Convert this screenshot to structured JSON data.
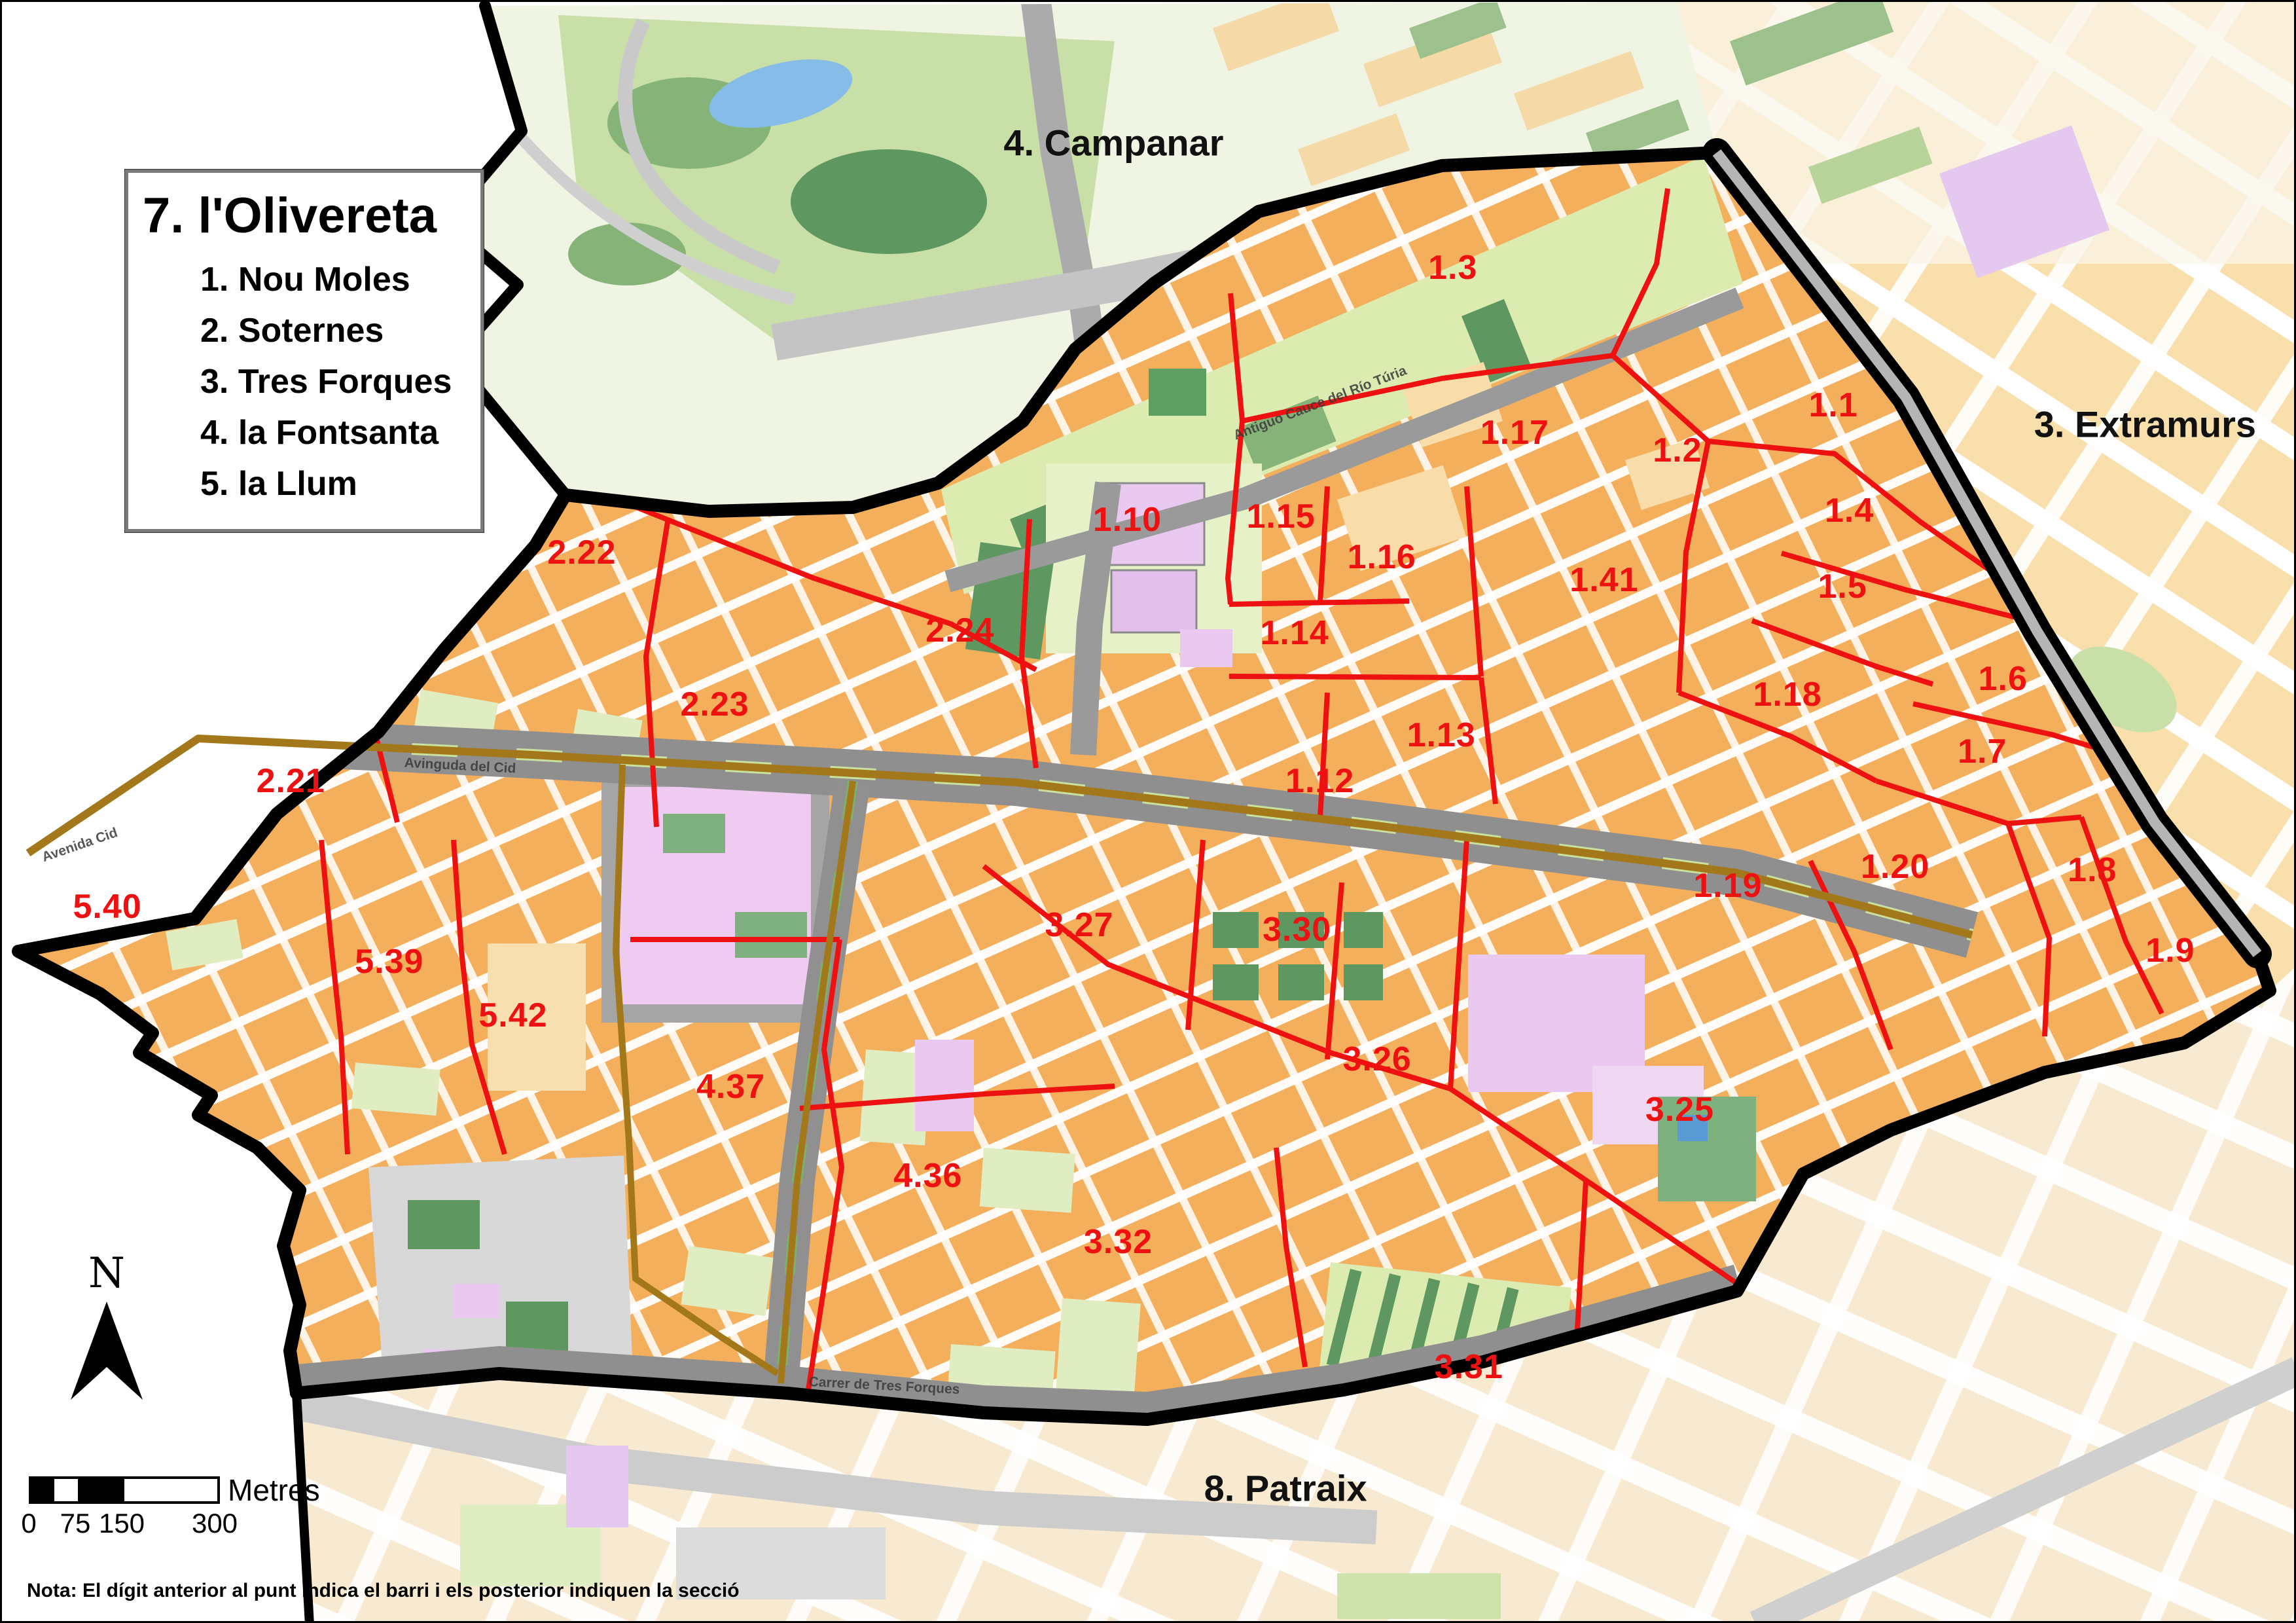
{
  "map": {
    "title_box": {
      "title": "7. l'Olivereta",
      "items": [
        "1. Nou Moles",
        "2. Soternes",
        "3. Tres Forques",
        "4. la Fontsanta",
        "5. la Llum"
      ]
    },
    "neighbor_districts": [
      {
        "name": "4. Campanar",
        "x_pct": 48.5,
        "y_pct": 8.7
      },
      {
        "name": "3. Extramurs",
        "x_pct": 93.5,
        "y_pct": 26.1
      },
      {
        "name": "8. Patraix",
        "x_pct": 56.0,
        "y_pct": 91.8
      }
    ],
    "sections": [
      {
        "label": "1.3",
        "x_pct": 63.3,
        "y_pct": 16.4
      },
      {
        "label": "1.1",
        "x_pct": 79.9,
        "y_pct": 24.9
      },
      {
        "label": "1.17",
        "x_pct": 66.0,
        "y_pct": 26.6
      },
      {
        "label": "1.2",
        "x_pct": 73.1,
        "y_pct": 27.7
      },
      {
        "label": "1.4",
        "x_pct": 80.6,
        "y_pct": 31.4
      },
      {
        "label": "1.15",
        "x_pct": 55.8,
        "y_pct": 31.8
      },
      {
        "label": "1.10",
        "x_pct": 49.1,
        "y_pct": 32.0
      },
      {
        "label": "2.22",
        "x_pct": 25.3,
        "y_pct": 34.0
      },
      {
        "label": "1.16",
        "x_pct": 60.2,
        "y_pct": 34.3
      },
      {
        "label": "1.41",
        "x_pct": 69.9,
        "y_pct": 35.7
      },
      {
        "label": "1.5",
        "x_pct": 80.3,
        "y_pct": 36.1
      },
      {
        "label": "2.24",
        "x_pct": 41.8,
        "y_pct": 38.8
      },
      {
        "label": "1.14",
        "x_pct": 56.4,
        "y_pct": 39.0
      },
      {
        "label": "1.6",
        "x_pct": 87.3,
        "y_pct": 41.8
      },
      {
        "label": "1.18",
        "x_pct": 77.9,
        "y_pct": 42.8
      },
      {
        "label": "2.23",
        "x_pct": 31.1,
        "y_pct": 43.4
      },
      {
        "label": "1.13",
        "x_pct": 62.8,
        "y_pct": 45.3
      },
      {
        "label": "1.7",
        "x_pct": 86.4,
        "y_pct": 46.3
      },
      {
        "label": "1.12",
        "x_pct": 57.5,
        "y_pct": 48.1
      },
      {
        "label": "2.21",
        "x_pct": 12.6,
        "y_pct": 48.1
      },
      {
        "label": "1.20",
        "x_pct": 82.6,
        "y_pct": 53.4
      },
      {
        "label": "1.8",
        "x_pct": 91.2,
        "y_pct": 53.6
      },
      {
        "label": "1.19",
        "x_pct": 75.3,
        "y_pct": 54.6
      },
      {
        "label": "5.40",
        "x_pct": 4.6,
        "y_pct": 55.9
      },
      {
        "label": "3.27",
        "x_pct": 47.0,
        "y_pct": 57.0
      },
      {
        "label": "3.30",
        "x_pct": 56.5,
        "y_pct": 57.3
      },
      {
        "label": "1.9",
        "x_pct": 94.6,
        "y_pct": 58.6
      },
      {
        "label": "5.39",
        "x_pct": 16.9,
        "y_pct": 59.3
      },
      {
        "label": "5.42",
        "x_pct": 22.3,
        "y_pct": 62.6
      },
      {
        "label": "3.26",
        "x_pct": 60.0,
        "y_pct": 65.3
      },
      {
        "label": "4.37",
        "x_pct": 31.8,
        "y_pct": 67.0
      },
      {
        "label": "3.25",
        "x_pct": 73.2,
        "y_pct": 68.4
      },
      {
        "label": "4.36",
        "x_pct": 40.4,
        "y_pct": 72.5
      },
      {
        "label": "3.32",
        "x_pct": 48.7,
        "y_pct": 76.6
      },
      {
        "label": "3.31",
        "x_pct": 64.0,
        "y_pct": 84.3
      }
    ],
    "street_labels": [
      {
        "text": "Avinguda del Cid",
        "x_pct": 20.0,
        "y_pct": 47.2,
        "rot": 3
      },
      {
        "text": "Avenida  Cid",
        "x_pct": 3.4,
        "y_pct": 52.1,
        "rot": -19
      },
      {
        "text": "Antiguo Cauce del Río Túria",
        "x_pct": 57.5,
        "y_pct": 24.8,
        "rot": -21
      },
      {
        "text": "Carrer de Tres Forques",
        "x_pct": 38.5,
        "y_pct": 85.5,
        "rot": 3
      }
    ],
    "north_arrow_label": "N",
    "scale_bar": {
      "tick_labels": [
        "0",
        "75",
        "150",
        "300"
      ],
      "unit_label": "Metres"
    },
    "note": "Nota: El dígit anterior al punt indica el barri i els posterior indiquen la secció",
    "legend_colors": {
      "section_line": "#EE1111",
      "district_boundary": "#000000",
      "barri_boundary": "#A3781B",
      "urban_block": "#F4AF5C",
      "green_area": "#5E9860",
      "facility_purple": "#ECCBF2",
      "road_grey": "#969696"
    }
  }
}
